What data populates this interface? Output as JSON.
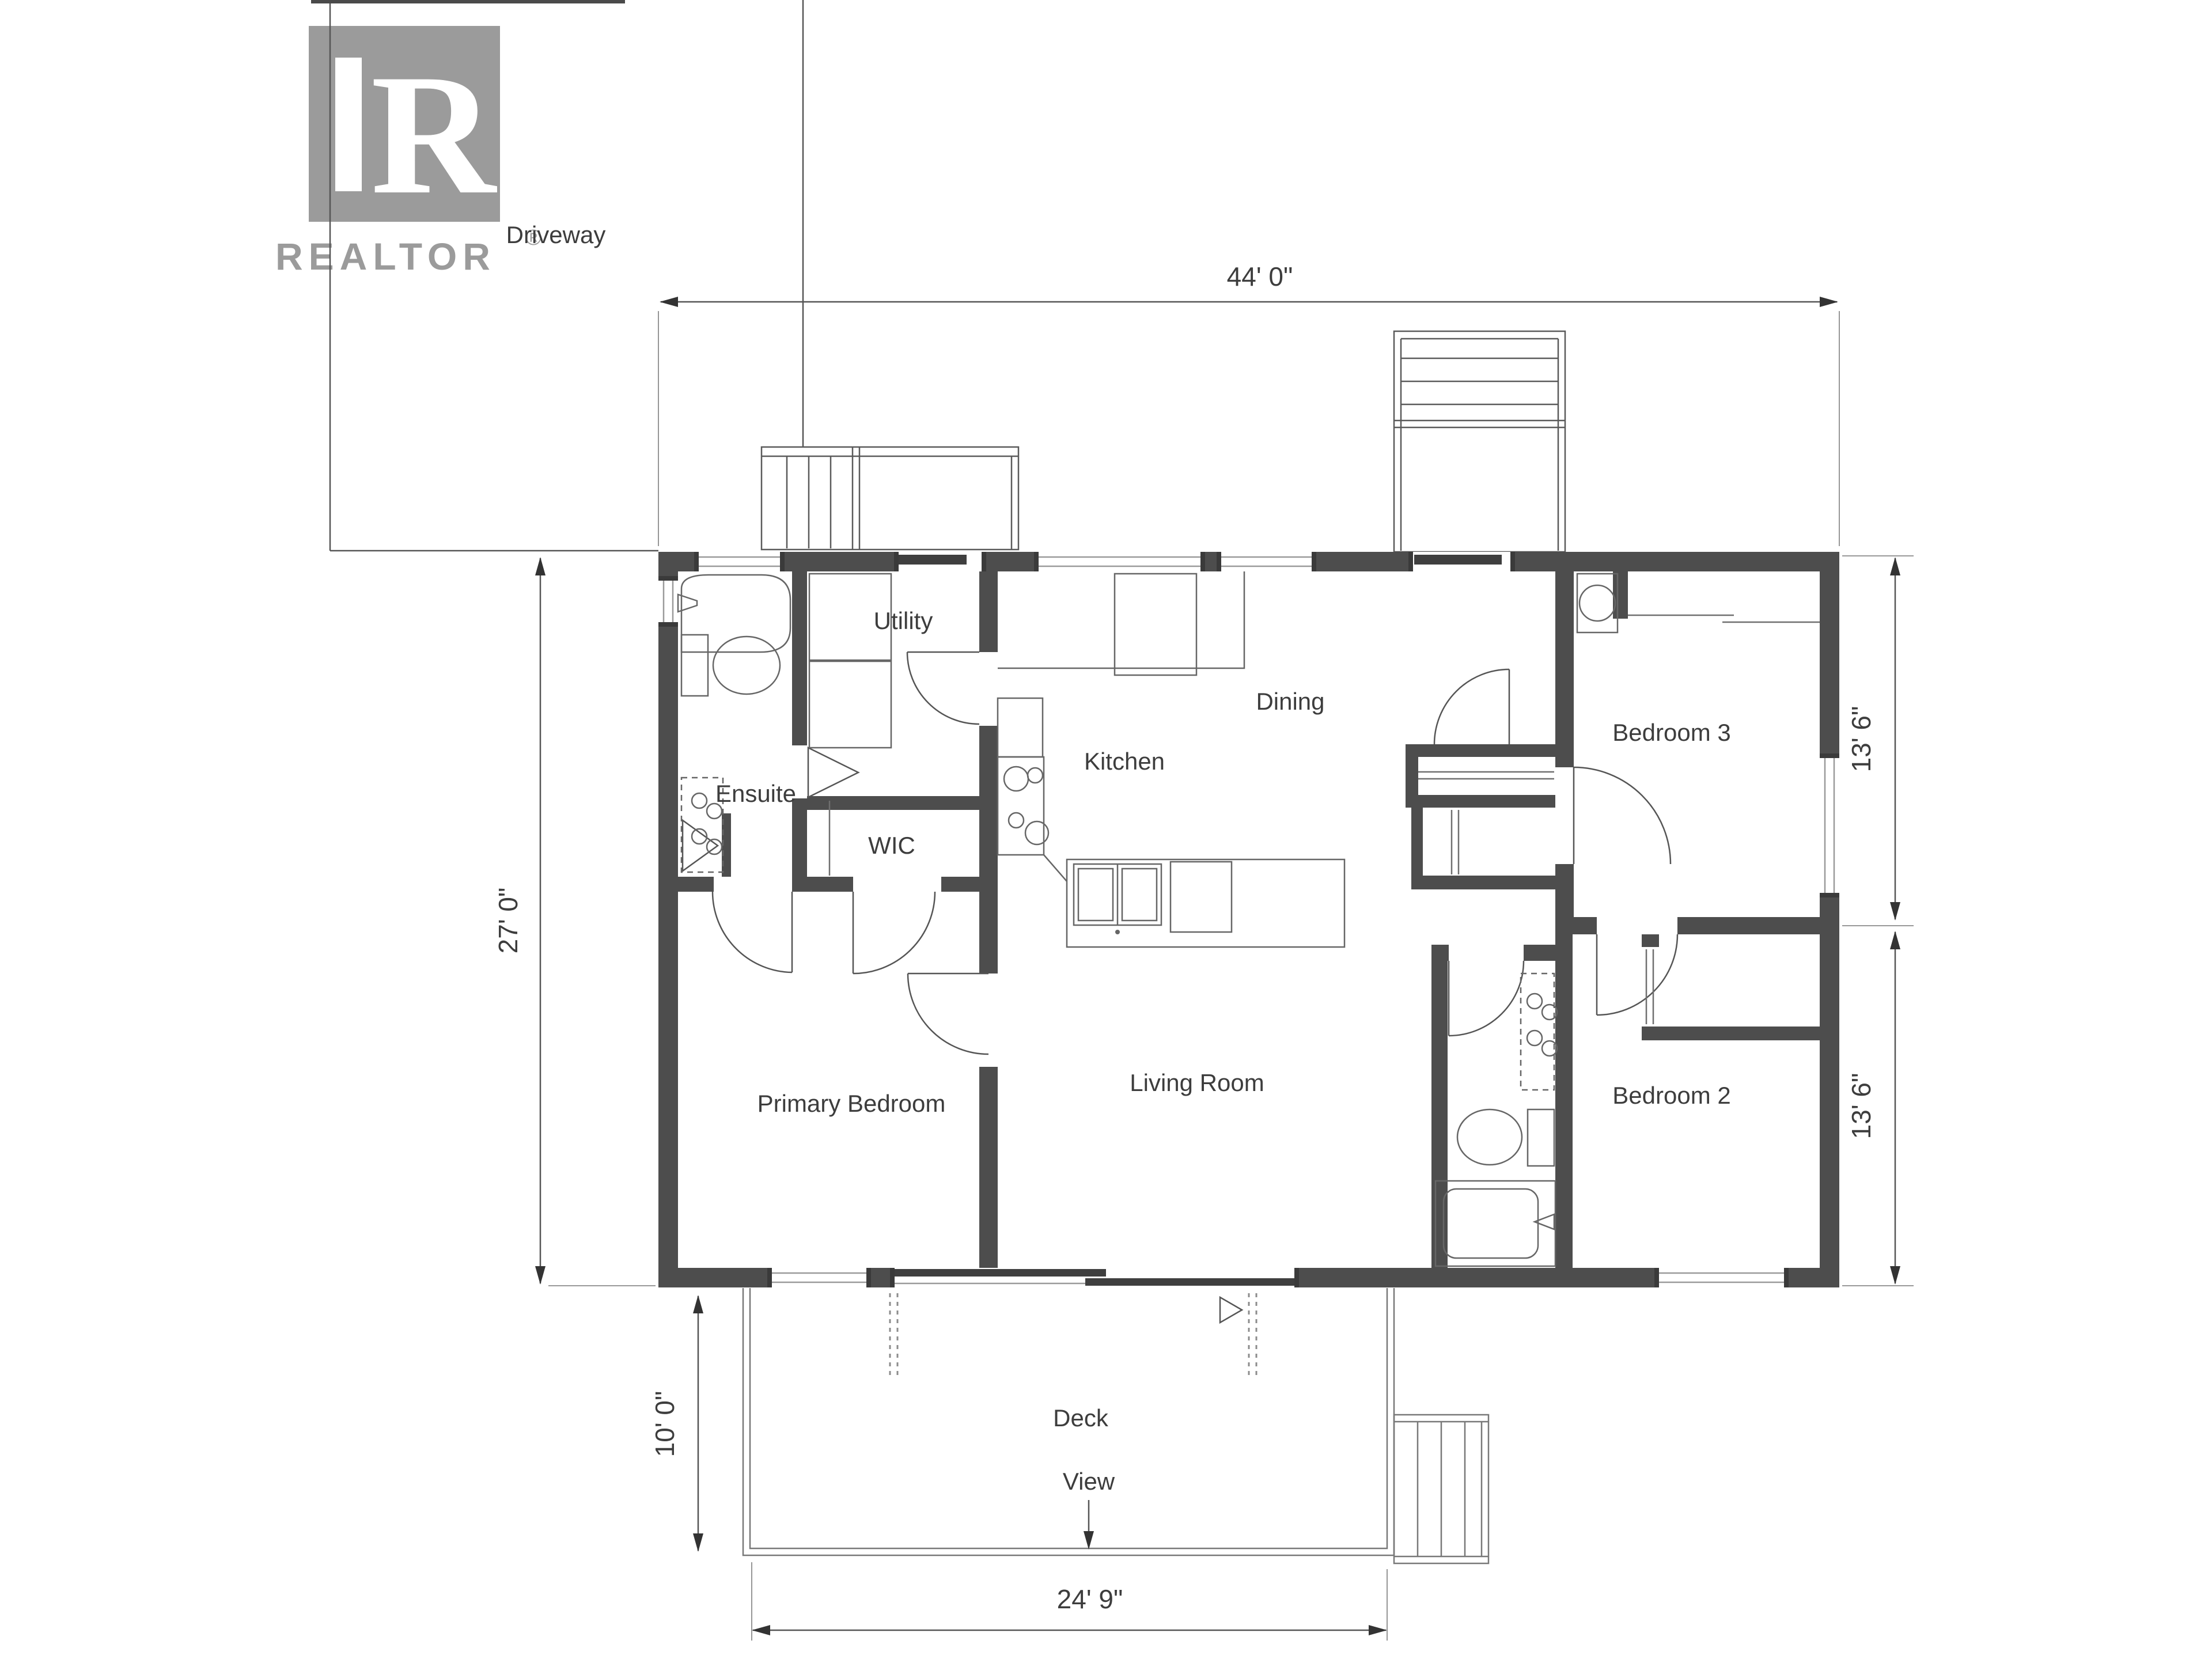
{
  "logo": {
    "brand": "REALTOR",
    "registered": "®",
    "monogram": "R"
  },
  "site": {
    "driveway": "Driveway",
    "deck": "Deck",
    "view": "View"
  },
  "rooms": {
    "utility": "Utility",
    "ensuite": "Ensuite",
    "wic": "WIC",
    "kitchen": "Kitchen",
    "dining": "Dining",
    "bedroom3": "Bedroom 3",
    "primary_bedroom": "Primary Bedroom",
    "living_room": "Living Room",
    "bedroom2": "Bedroom 2"
  },
  "dimensions": {
    "overall_width": "44' 0\"",
    "overall_depth": "27' 0\"",
    "bedroom3_side": "13' 6\"",
    "bedroom2_side": "13' 6\"",
    "deck_depth": "10' 0\"",
    "deck_width": "24' 9\""
  },
  "colors": {
    "wall": "#4d4d4d",
    "fixture_line": "#666666",
    "dimension_line": "#555555",
    "text": "#3d3d3d",
    "logo_gray": "#9b9b9b",
    "background": "#ffffff"
  }
}
